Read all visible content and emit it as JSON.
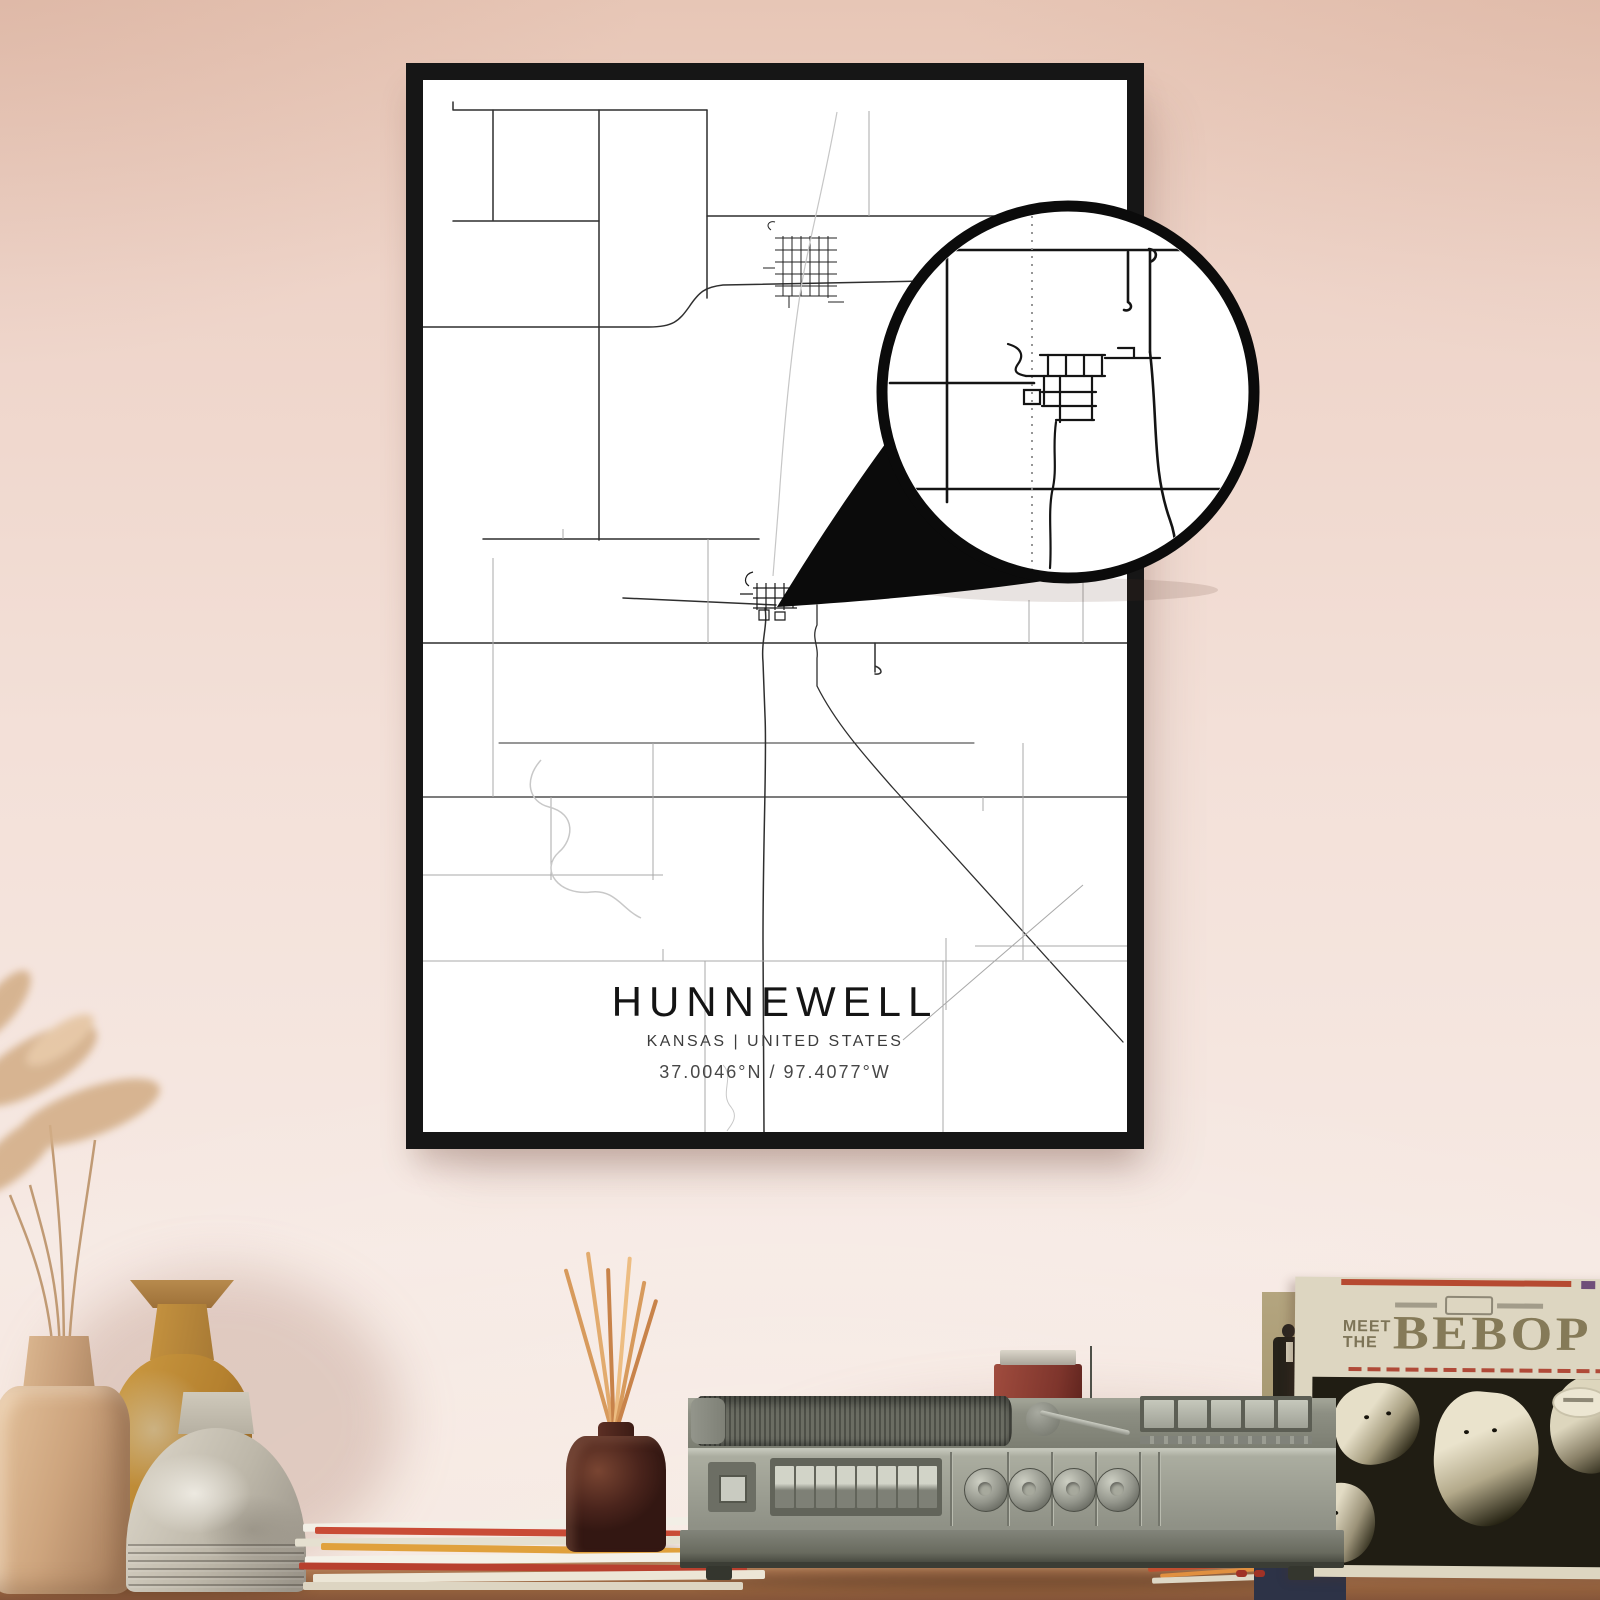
{
  "poster": {
    "title": "HUNNEWELL",
    "region_line": "KANSAS | UNITED STATES",
    "coordinates": "37.0046°N / 97.4077°W"
  },
  "album": {
    "title_line1": "MEET",
    "title_line2": "THE",
    "title_main": "BEBOP"
  },
  "colors": {
    "wall_top": "#e7c6b6",
    "wall_bottom": "#f6e9e3",
    "frame": "#161616",
    "poster_bg": "#ffffff",
    "map_main": "#2f2f2f",
    "map_minor": "#a9a9a9",
    "map_water": "#c8c8c8",
    "callout_ink": "#0b0b0b",
    "table_wood": "#9a6a47",
    "player_body": "#9b9d91",
    "album_cream": "#ddd6c1",
    "album_ink": "#857a58",
    "accent_red": "#b64a31"
  }
}
